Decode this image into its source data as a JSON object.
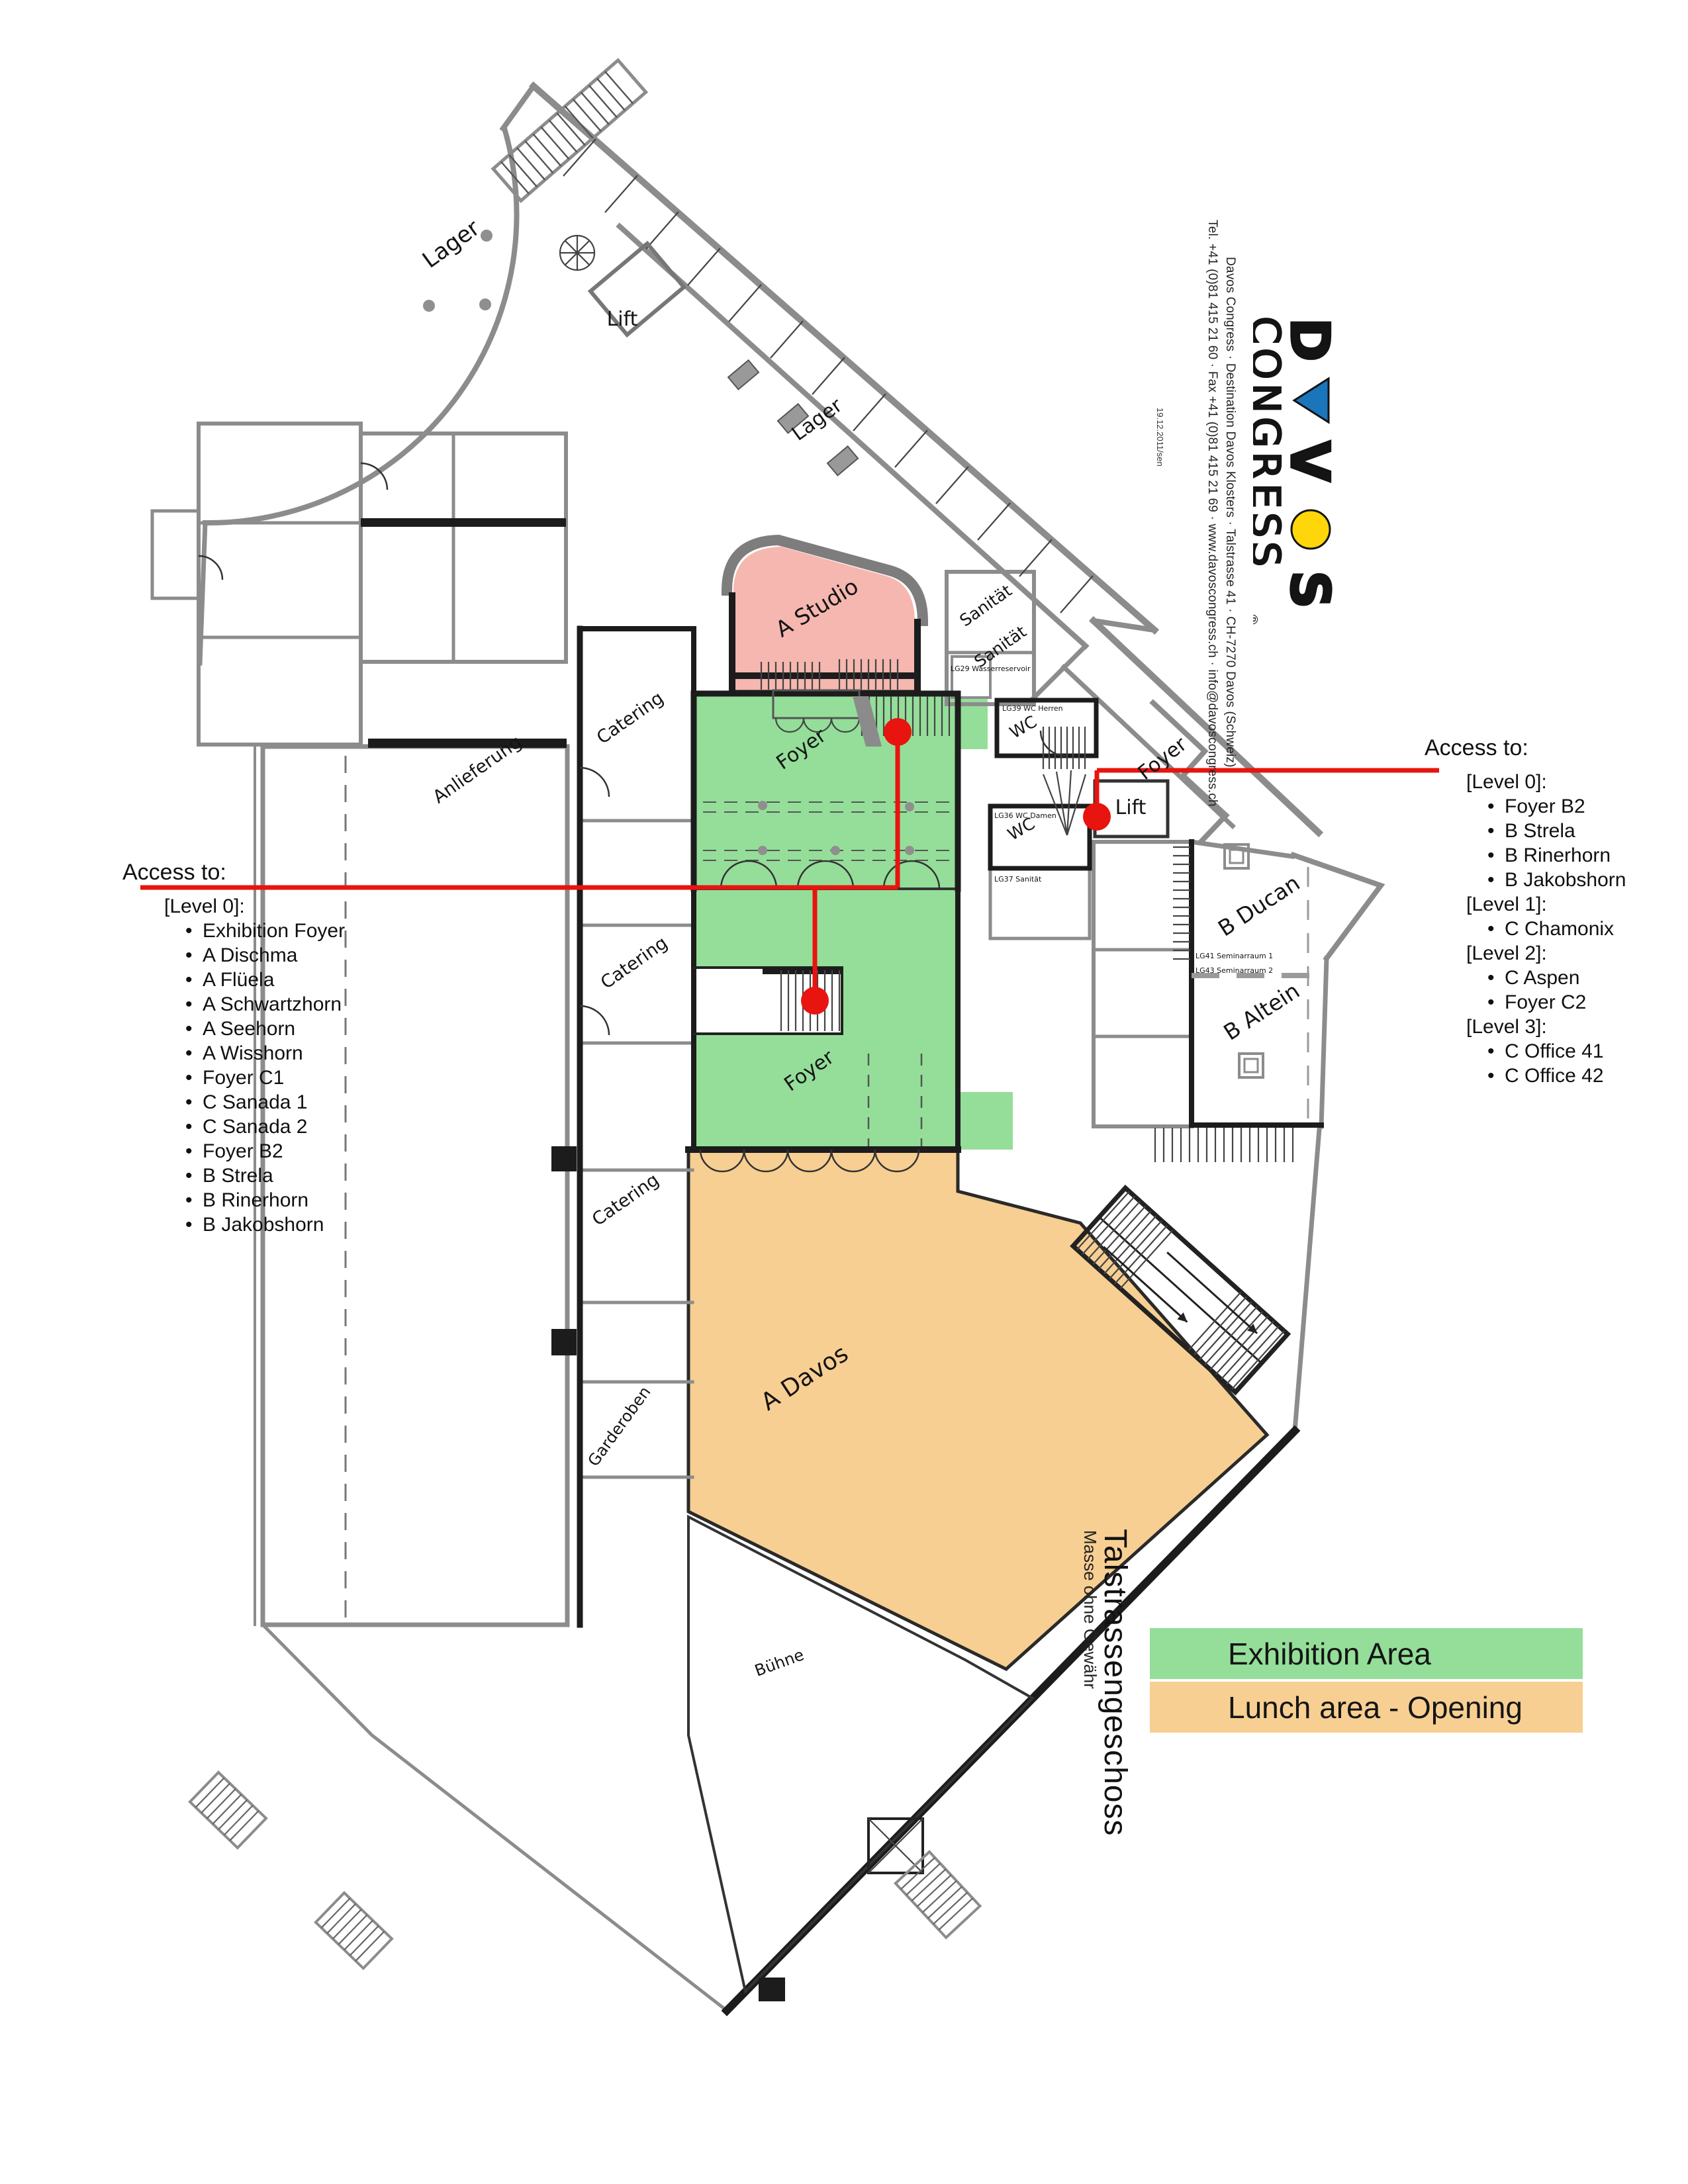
{
  "page": {
    "title_vertical": "Talstrassengeschoss",
    "subtitle_vertical": "Masse ohne Gewähr",
    "date_note": "19.12.2011/sen"
  },
  "logo": {
    "word1": "DAVOS",
    "word2": "CONGRESS",
    "registered": "®"
  },
  "contact": {
    "line1": "Davos Congress · Destination Davos Klosters  ·  Talstrasse 41 · CH-7270 Davos (Schweiz)",
    "line2": "Tel. +41 (0)81 415 21 60 · Fax +41 (0)81 415 21 69 · www.davoscongress.ch · info@davoscongress.ch"
  },
  "colors": {
    "exhibition_green": "#94de99",
    "lunch_orange": "#f7cf92",
    "studio_pink": "#f5b7af",
    "annotation_red": "#e8140f",
    "logo_blue": "#1b75bb",
    "logo_yellow": "#ffd60a"
  },
  "legend": {
    "items": [
      {
        "label": "Exhibition Area",
        "color": "#94de99"
      },
      {
        "label": "Lunch area - Opening",
        "color": "#f7cf92"
      }
    ]
  },
  "access_left": {
    "title": "Access to:",
    "groups": [
      {
        "level": "[Level 0]:",
        "items": [
          "Exhibition Foyer",
          "A Dischma",
          "A Flüela",
          "A Schwartzhorn",
          "A Seehorn",
          "A Wisshorn",
          "Foyer C1",
          "C Sanada 1",
          "C Sanada 2",
          "Foyer B2",
          "B Strela",
          "B Rinerhorn",
          "B Jakobshorn"
        ]
      }
    ]
  },
  "access_right": {
    "title": "Access to:",
    "groups": [
      {
        "level": "[Level 0]:",
        "items": [
          "Foyer B2",
          "B Strela",
          "B Rinerhorn",
          "B Jakobshorn"
        ]
      },
      {
        "level": "[Level 1]:",
        "items": [
          "C Chamonix"
        ]
      },
      {
        "level": "[Level 2]:",
        "items": [
          "C Aspen",
          "Foyer C2"
        ]
      },
      {
        "level": "[Level 3]:",
        "items": [
          "C Office 41",
          "C Office 42"
        ]
      }
    ]
  },
  "map": {
    "labels": {
      "lager_top": "Lager",
      "lift_top": "Lift",
      "lager_corridor": "Lager",
      "a_studio": "A Studio",
      "sanitaet_1": "Sanität",
      "sanitaet_2": "Sanität",
      "catering_1": "Catering",
      "anlieferung": "Anlieferung",
      "foyer_upper": "Foyer",
      "wc_1": "WC",
      "foyer_right": "Foyer",
      "wc_2": "WC",
      "lift_right": "Lift",
      "b_ducan": "B Ducan",
      "b_altein": "B Altein",
      "catering_2": "Catering",
      "foyer_lower": "Foyer",
      "catering_3": "Catering",
      "garderoben": "Garderoben",
      "a_davos": "A Davos",
      "buehne": "Bühne"
    },
    "micro_labels": [
      {
        "text": "LG39 WC Herren"
      },
      {
        "text": "LG36 WC Damen"
      },
      {
        "text": "LG37 Sanität"
      },
      {
        "text": "LG29 Wasserreservoir"
      },
      {
        "text": "LG41 Seminarraum 1"
      },
      {
        "text": "LG43 Seminarraum 2"
      }
    ]
  }
}
